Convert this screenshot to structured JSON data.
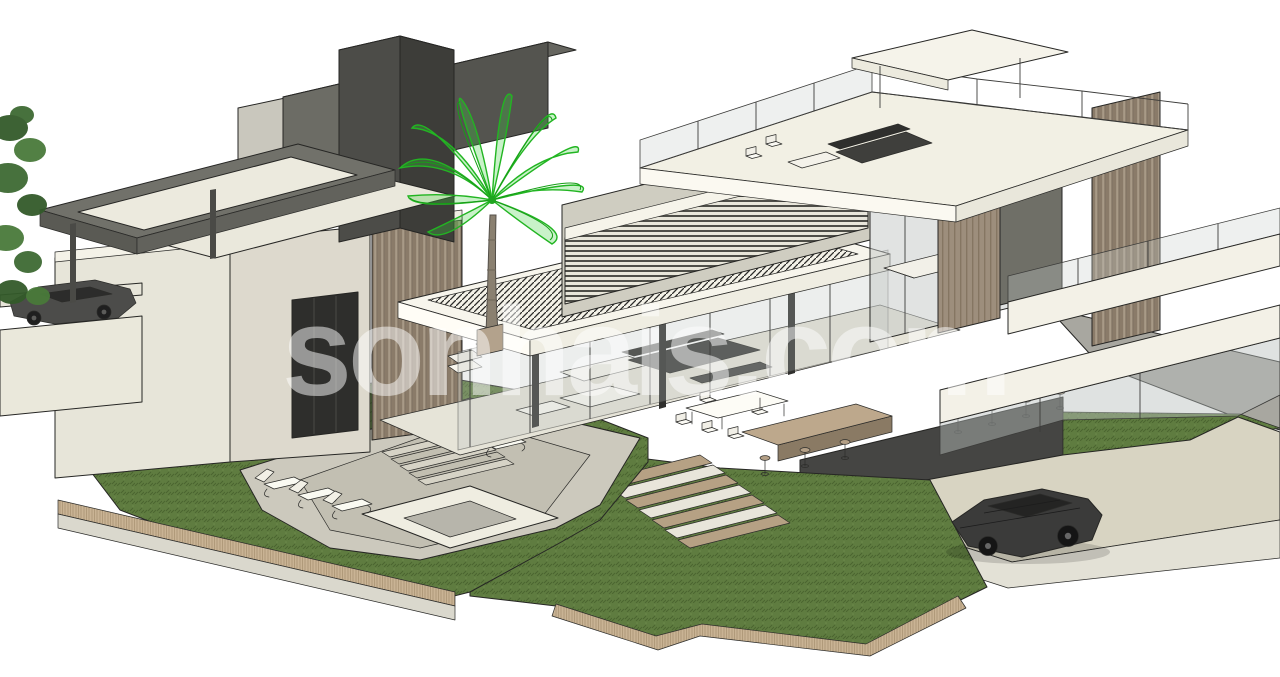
{
  "watermark": {
    "text": "sonhais.com",
    "color": "#ffffff",
    "opacity": "0.5"
  },
  "palette": {
    "background": "#ffffff",
    "linework": "#262624",
    "wall_cream": "#e7e5d9",
    "wall_light": "#f4f2e8",
    "wall_gray": "#c9c7bd",
    "dark_volume": "#4c4c48",
    "glass_tint": "#c3c8c6",
    "grass": "#5f7c40",
    "grass_shadow": "#4b6530",
    "palm_green": "#2dc42d",
    "soil": "#c9b394",
    "deck_concrete": "#ccc9bd",
    "driveway": "#d8d4c2",
    "basement": "#454543",
    "wood_slats": "#a89a87",
    "wood_counter": "#bda88c",
    "car_body": "#3b3b3a"
  },
  "scene": {
    "description": "Isometric 3D CAD cutaway model of a modern two-storey villa with pool terrace, lawns, palm tree and parked cars",
    "objects": [
      "dark-roof-towers",
      "pergola-frame",
      "palm-tree",
      "left-annex",
      "slatted-screens",
      "hatched-canopy",
      "rooftop-terrace",
      "glass-facades",
      "pool-deck",
      "sun-loungers",
      "spa",
      "lawns",
      "garden-stairs",
      "driveway",
      "sports-car",
      "sedan-car",
      "side-tree",
      "watermark"
    ]
  }
}
